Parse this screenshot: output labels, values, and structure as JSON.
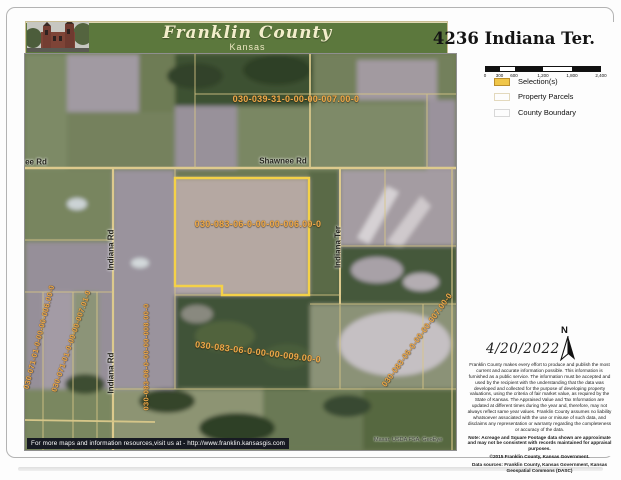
{
  "header": {
    "county": "Franklin County",
    "state": "Kansas"
  },
  "title": "4236 Indiana Ter.",
  "scalebar": {
    "ticks": [
      "0",
      "300",
      "600",
      "1,200",
      "1,800",
      "2,400"
    ]
  },
  "legend": {
    "items": [
      {
        "label": "Selection(s)",
        "swatch_color": "#f0c649"
      },
      {
        "label": "Property Parcels",
        "swatch_color": "#ffffff"
      },
      {
        "label": "County Boundary",
        "swatch_color": "#ffffff"
      }
    ]
  },
  "map": {
    "roads": [
      {
        "name": "ee Rd"
      },
      {
        "name": "Shawnee Rd"
      },
      {
        "name": "Indiana Rd"
      },
      {
        "name": "Indiana Rd"
      },
      {
        "name": "Indiana Ter"
      }
    ],
    "parcels": [
      {
        "id": "030-039-31-0-00-00-007.00-0"
      },
      {
        "id": "030-083-06-0-00-00-006.00-0",
        "selected": true
      },
      {
        "id": "030-083-06-0-00-00-009.00-0"
      },
      {
        "id": "030-071-01-0-00-00-006.00-0"
      },
      {
        "id": "030-071-01-0-00-00-007.01-0"
      },
      {
        "id": "030-083-06-0-00-00-008.00-0"
      },
      {
        "id": "030-083-06-0-00-00-007.00-0"
      }
    ],
    "attribution": "Maxar, USDA FSA, GeoEye",
    "selection_color": "#f4d148",
    "parcel_line_color": "#d9c786"
  },
  "compass": {
    "label": "N"
  },
  "date": "4/20/2022",
  "disclaimer": {
    "body": "Franklin County makes every effort to produce and publish the most current and accurate information possible. This information is furnished as a public service. The information must be accepted and used by the recipient with the understanding that the data was developed and collected for the purpose of developing property valuations, using the criteria of fair market value, as required by the State of Kansas. The Appraised Value and Tax Information are updated at different times during the year and, therefore, may not always reflect same year values. Franklin County assumes no liability whatsoever associated with the use or misuse of such data, and disclaims any representation or warranty regarding the completeness or accuracy of the data.",
    "note": "Note: Acreage and Square Footage data shown are approximate and may not be consistent with records maintained for appraisal purposes.",
    "copyright": "©2015 Franklin County, Kansas Government.",
    "sources": "Data sources: Franklin County, Kansas Government, Kansas Geospatial Commons (DASC)"
  },
  "footer": {
    "banner": "For more maps and information resources,visit us at - http://www.franklin.kansasgis.com"
  }
}
